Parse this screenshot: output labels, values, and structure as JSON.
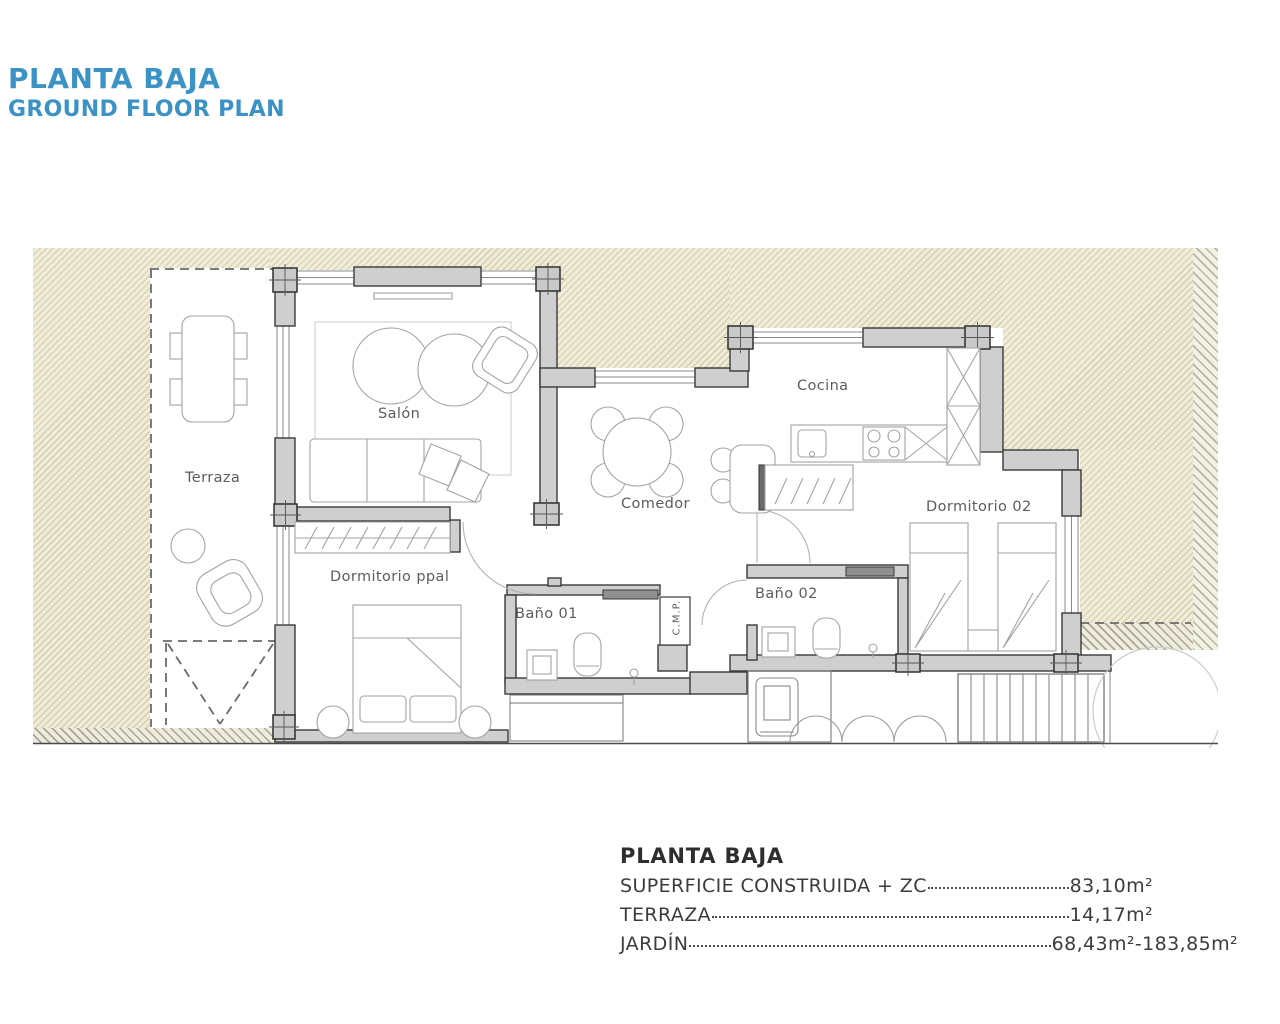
{
  "header": {
    "title": "PLANTA BAJA",
    "subtitle": "GROUND FLOOR PLAN"
  },
  "plan": {
    "rooms": {
      "terraza": "Terraza",
      "salon": "Salón",
      "comedor": "Comedor",
      "cocina": "Cocina",
      "dormitorio02": "Dormitorio 02",
      "dormitorio_ppal": "Dormitorio ppal",
      "bano01": "Baño 01",
      "bano02": "Baño 02",
      "cmp": "C.M.P."
    }
  },
  "summary": {
    "title": "PLANTA BAJA",
    "rows": [
      {
        "label": "SUPERFICIE CONSTRUIDA + ZC",
        "value": "83,10m²"
      },
      {
        "label": "TERRAZA",
        "value": "14,17m²"
      },
      {
        "label": "JARDÍN",
        "value": "68,43m²-183,85m²"
      }
    ]
  },
  "colors": {
    "accent": "#3b92c4",
    "garden_fill": "#f0ecda",
    "wall_fill": "#cfcfcf",
    "wall_stroke": "#3a3a3a"
  }
}
